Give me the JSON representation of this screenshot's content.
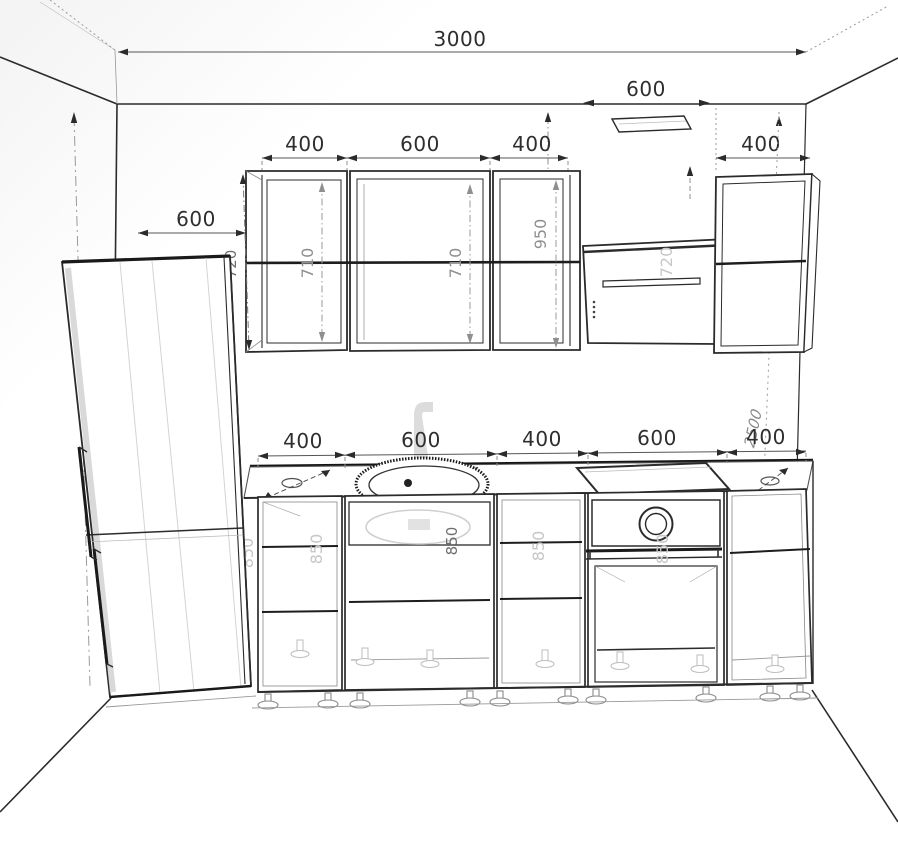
{
  "drawing": {
    "type": "kitchen-elevation-wireframe",
    "units": "mm",
    "colors": {
      "line": "#2b2b2b",
      "ghost": "#c7c7c7",
      "dim_line": "#8f8f8f",
      "background": "#ffffff"
    },
    "dims": {
      "total_width": "3000",
      "vent_width": "600",
      "upper_row": [
        "400",
        "600",
        "400"
      ],
      "upper_right": "400",
      "left_offset": "600",
      "upper_left_height": "720",
      "upper_inner_heights": [
        "710",
        "710"
      ],
      "upper_right_inner": "950",
      "hood_height": "720",
      "wall_height_left": "2500",
      "fridge_inner_height": "1850",
      "wall_height_right": "2500",
      "base_row": [
        "400",
        "600",
        "400",
        "600",
        "400"
      ],
      "base_heights": [
        "850",
        "850",
        "850",
        "850",
        "850"
      ],
      "sink_depth": "600"
    }
  }
}
